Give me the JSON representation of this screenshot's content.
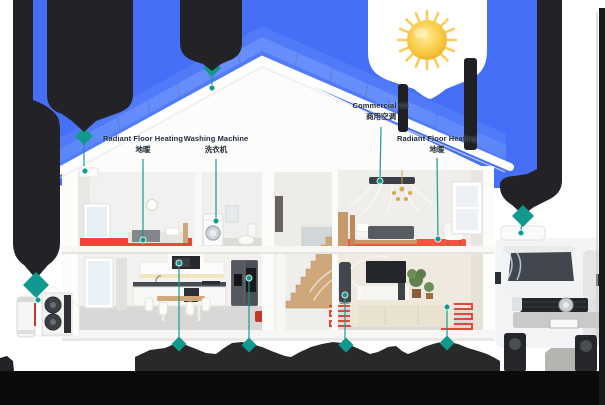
{
  "page": {
    "labels": {
      "left_floor_heating": {
        "en": "Radiant Floor Heating",
        "zh": "地暖"
      },
      "washing_machine": {
        "en": "Washing Machine",
        "zh": "洗衣机"
      },
      "commercial_ac": {
        "en": "Commercial AC",
        "zh": "商用空调"
      },
      "right_floor_heating": {
        "en": "Radiant Floor Heating",
        "zh": "地暖"
      }
    },
    "colors": {
      "backdrop_blue": "#466ff7",
      "callout_dark": "#232327",
      "band_dark": "#29292b",
      "footer_black": "#0b0b0b",
      "accent_teal": "#12998f",
      "heating_red": "#e8473a",
      "rug_red": "#ef5540",
      "sun_core": "#f2b32b",
      "sun_ray": "#f5cd5a"
    },
    "icons": [
      "sun-icon",
      "solar-panel-roof",
      "callout-diamond",
      "heat-pump-outdoor-unit",
      "water-tank",
      "wall-ac-unit",
      "washing-machine",
      "toilet",
      "ceiling-ac-cassette",
      "chandelier",
      "bed",
      "armchair",
      "window",
      "microwave",
      "refrigerator",
      "oven",
      "dining-table",
      "staircase",
      "tower-ac-unit",
      "tv",
      "sofa",
      "potted-plant",
      "radiant-floor-coil",
      "delivery-van",
      "van-rooftop-ac"
    ]
  }
}
